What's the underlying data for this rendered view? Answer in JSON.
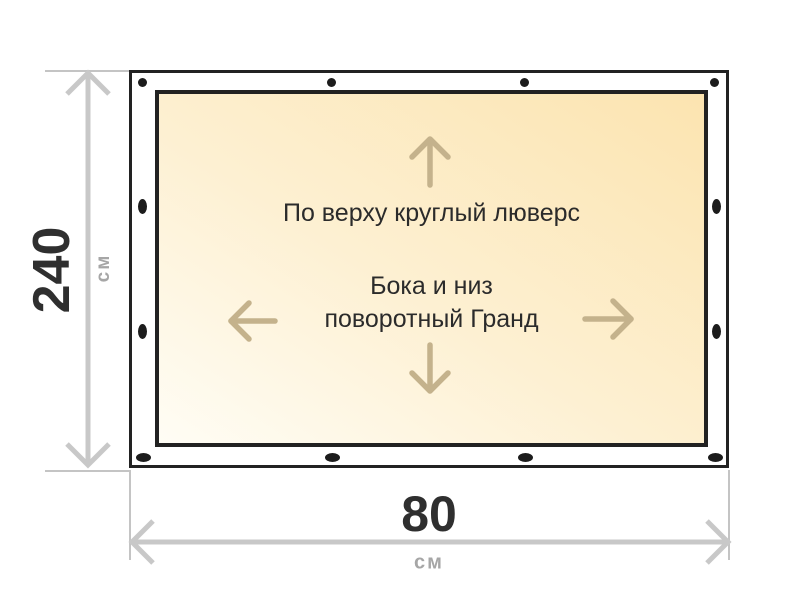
{
  "banner": {
    "top_note": "По верху круглый люверс",
    "center_note": [
      "Бока и низ",
      "поворотный Гранд"
    ],
    "grommets": {
      "top_edge_count": 4,
      "bottom_edge_count": 4,
      "left_edge_count": 2,
      "right_edge_count": 2
    },
    "colors": {
      "frame_border": "#222222",
      "margin": "#ffffff",
      "canvas_gradient_start": "#fffdf5",
      "canvas_gradient_end": "#fce4b0",
      "direction_arrow": "#c4b28c",
      "note_text": "#2b2b2b",
      "grommet": "#1c1c1c"
    }
  },
  "dimensions": {
    "height": {
      "value": "240",
      "unit": "см"
    },
    "width": {
      "value": "80",
      "unit": "см"
    },
    "colors": {
      "dimension_line": "#c8c8c8",
      "extension_line": "#c4c4c4",
      "value_text": "#2f2f2f",
      "unit_text": "#a6a6a6"
    }
  }
}
